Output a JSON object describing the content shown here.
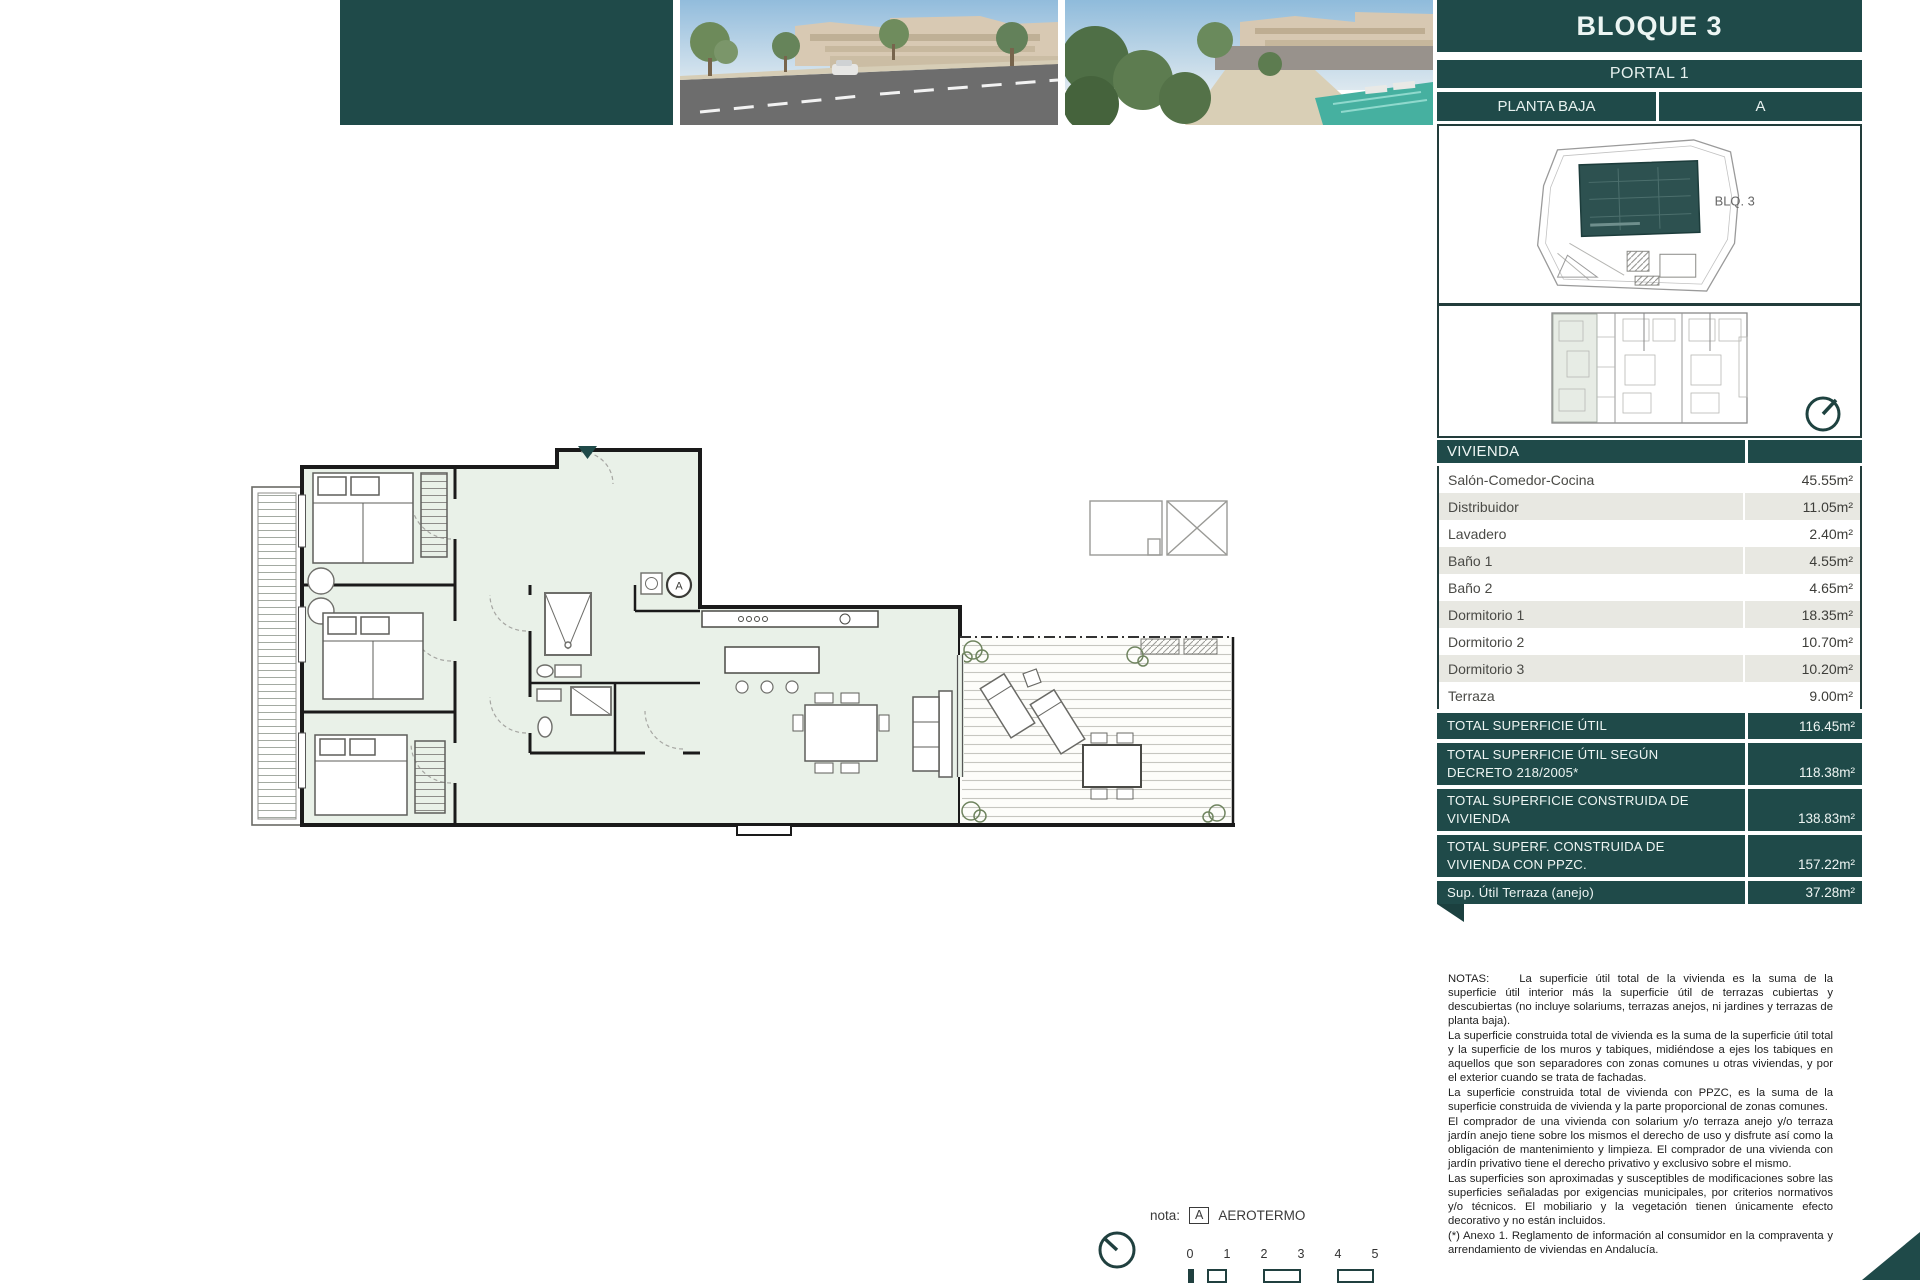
{
  "colors": {
    "teal": "#1f4a49",
    "row_alt": "#e8e8e2",
    "plan_fill": "#e9f1e8",
    "wall": "#1a1a1a"
  },
  "header": {
    "block_title": "BLOQUE 3",
    "portal": "PORTAL 1",
    "floor": "PLANTA BAJA",
    "unit": "A"
  },
  "site_panel": {
    "block_label": "BLQ. 3"
  },
  "table": {
    "header": "VIVIENDA",
    "rows": [
      {
        "label": "Salón-Comedor-Cocina",
        "value": "45.55m²"
      },
      {
        "label": "Distribuidor",
        "value": "11.05m²"
      },
      {
        "label": "Lavadero",
        "value": "2.40m²"
      },
      {
        "label": "Baño 1",
        "value": "4.55m²"
      },
      {
        "label": "Baño 2",
        "value": "4.65m²"
      },
      {
        "label": "Dormitorio 1",
        "value": "18.35m²"
      },
      {
        "label": "Dormitorio 2",
        "value": "10.70m²"
      },
      {
        "label": "Dormitorio 3",
        "value": "10.20m²"
      },
      {
        "label": "Terraza",
        "value": "9.00m²"
      }
    ],
    "totals": [
      {
        "label": "TOTAL SUPERFICIE ÚTIL",
        "value": "116.45m²"
      },
      {
        "label": "TOTAL SUPERFICIE ÚTIL SEGÚN DECRETO 218/2005*",
        "value": "118.38m²"
      },
      {
        "label": "TOTAL SUPERFICIE CONSTRUIDA DE VIVIENDA",
        "value": "138.83m²"
      },
      {
        "label": "TOTAL SUPERF. CONSTRUIDA DE VIVIENDA CON PPZC.",
        "value": "157.22m²"
      },
      {
        "label": "Sup. Útil Terraza (anejo)",
        "value": "37.28m²"
      }
    ]
  },
  "notes": {
    "label": "NOTAS:",
    "paragraphs": [
      "La superficie útil total de la vivienda es la suma de la superficie útil interior más la superficie útil de terrazas cubiertas y descubiertas (no incluye solariums, terrazas anejos, ni jardines y terrazas de planta baja).",
      "La superficie construida total de vivienda es la suma de la superficie útil total y la superficie de los muros y tabiques, midiéndose a ejes los tabiques en aquellos que son separadores con zonas comunes u otras viviendas, y por el exterior cuando se trata de fachadas.",
      "La superficie construida total de vivienda con PPZC, es la suma de la superficie construida de vivienda y la parte proporcional de zonas comunes.",
      "El comprador de una vivienda con solarium y/o terraza anejo y/o terraza jardín anejo tiene sobre los mismos el derecho de uso y disfrute así como la obligación de mantenimiento y limpieza. El comprador de una vivienda con jardín privativo tiene el derecho privativo y exclusivo sobre el mismo.",
      "Las superficies son aproximadas y susceptibles de modificaciones sobre las superficies señaladas por exigencias municipales, por criterios normativos y/o técnicos. El mobiliario y la vegetación tienen únicamente efecto decorativo y no están incluidos.",
      "(*) Anexo 1. Reglamento de información al consumidor en la compraventa y arrendamiento de viviendas en Andalucía."
    ]
  },
  "plan": {
    "aerotermo_letter": "A"
  },
  "footer": {
    "nota_label": "nota:",
    "aerotermo_box_letter": "A",
    "aerotermo_text": "AEROTERMO",
    "scale_ticks": [
      "0",
      "1",
      "2",
      "3",
      "4",
      "5"
    ]
  }
}
